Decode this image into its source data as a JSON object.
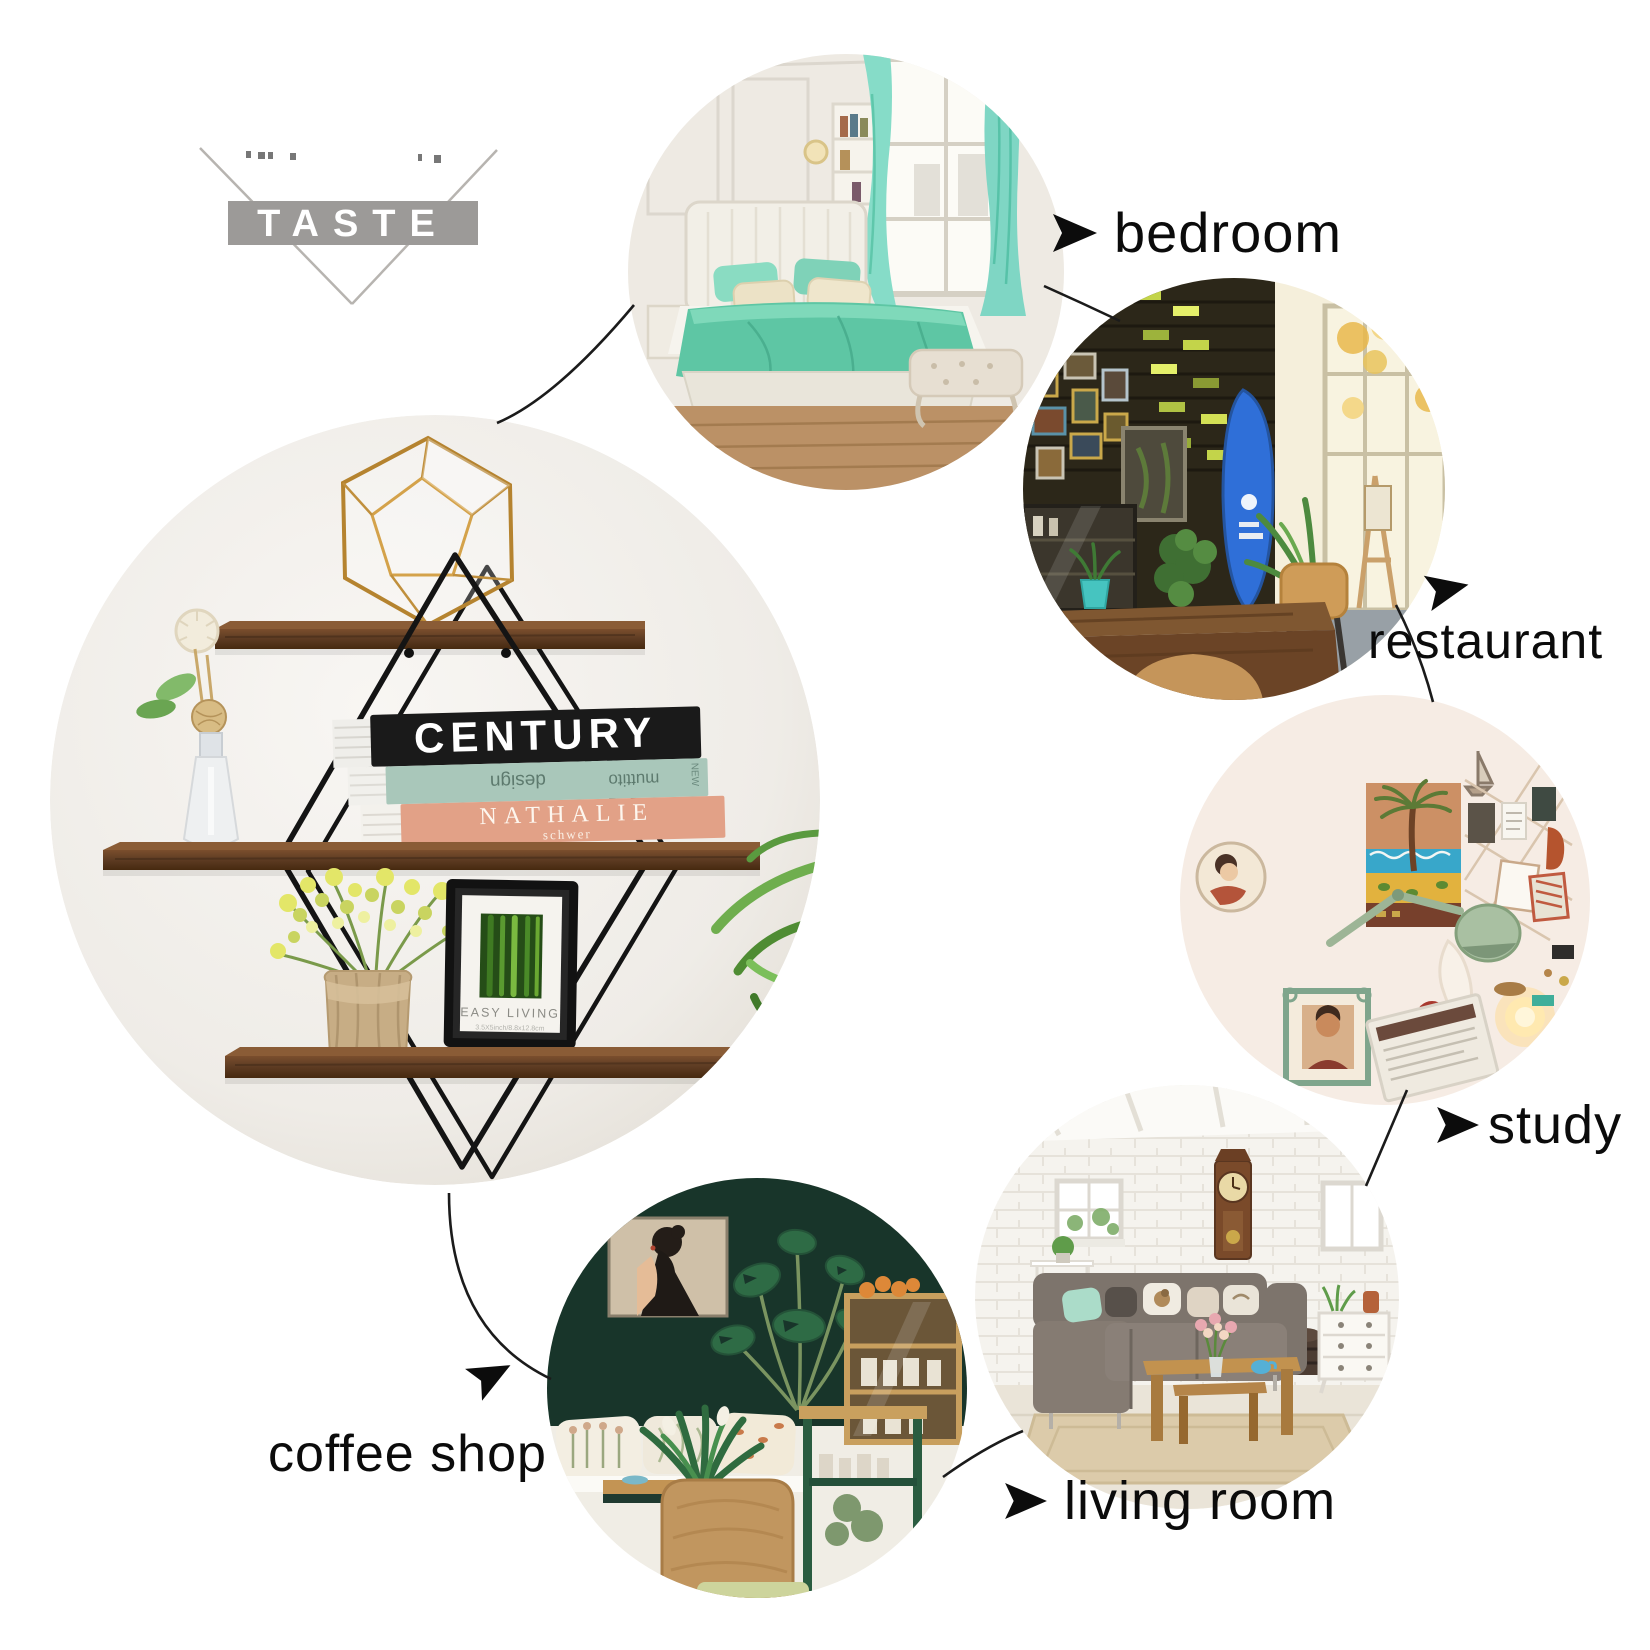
{
  "logo": {
    "text": "TASTE"
  },
  "callouts": [
    {
      "label": "bedroom"
    },
    {
      "label": "restaurant"
    },
    {
      "label": "study"
    },
    {
      "label": "living room"
    },
    {
      "label": "coffee shop"
    }
  ],
  "product": {
    "book_top": "CENTURY",
    "book_mid_word1": "design",
    "book_mid_word2": "muttito",
    "book_mid_edge": "NEW",
    "book_bottom_line1": "NATHALIE",
    "book_bottom_line2": "schwer",
    "frame_title": "EASY LIVING",
    "frame_size": "3.5X5inch/8.8x12.8cm"
  },
  "colors": {
    "label_text": "#0b0b0b",
    "logo_gray": "#9c9a98",
    "shelf_wood": "#5f3d24",
    "wire_black": "#141414",
    "terrarium_gold": "#c08f3c",
    "teal_book": "#a9c7ba",
    "salmon_book": "#e2a187",
    "bed_mint": "#5ec6a4",
    "surfboard_blue": "#2f6fd8",
    "coffee_wall_green": "#18352a"
  }
}
